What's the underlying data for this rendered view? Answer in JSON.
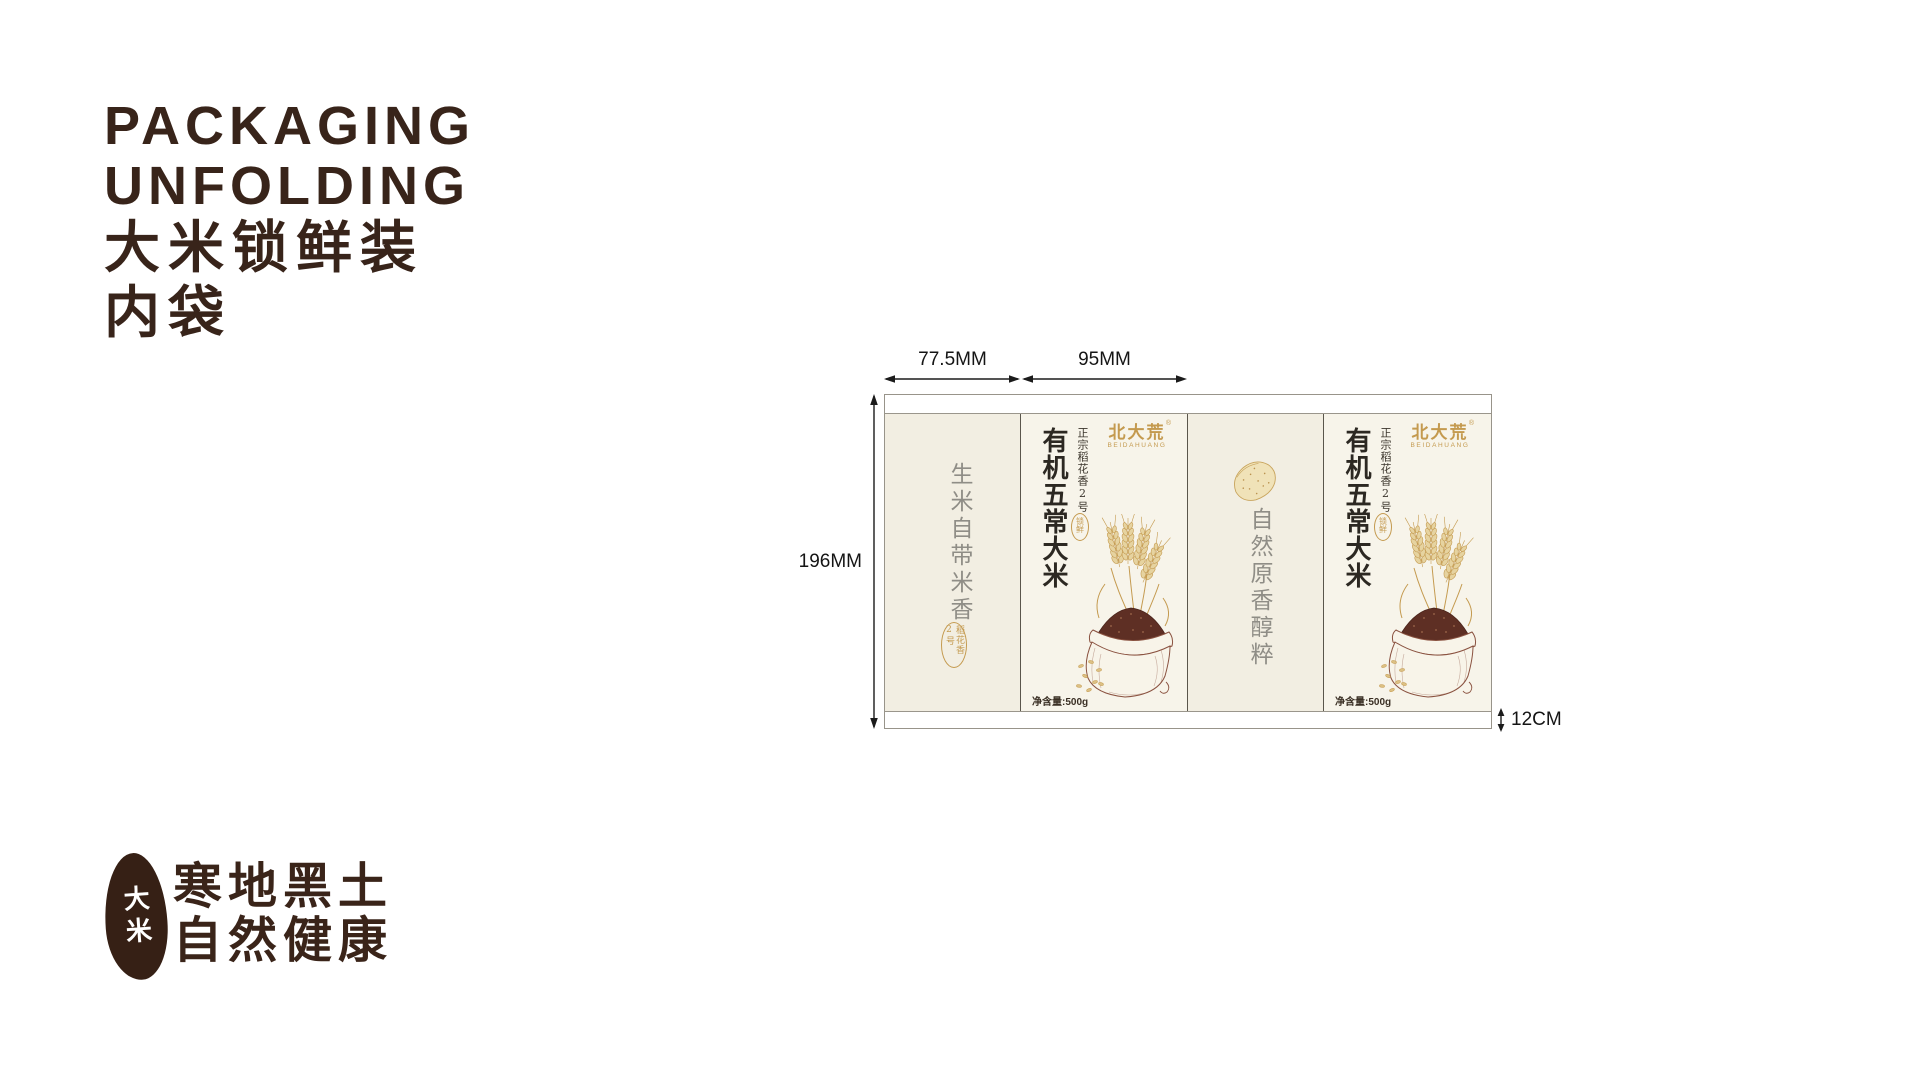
{
  "title": {
    "line1": "PACKAGING",
    "line2": "UNFOLDING",
    "line3": "大米锁鲜装",
    "line4": "内袋"
  },
  "dimensions": {
    "front_fold_width": "77.5MM",
    "main_panel_width": "95MM",
    "bag_height": "196MM",
    "side_depth": "12CM"
  },
  "package": {
    "left_fold_panel": {
      "slogan": "生米自带米香",
      "seal": "稻花香2号"
    },
    "main_panel": {
      "brand": "北大荒",
      "brand_en": "BEIDAHUANG",
      "trademark": "®",
      "origin": "正宗稻花香2号",
      "product": "有机五常大米",
      "seal": "锁鲜",
      "net_weight": "净含量:500g"
    },
    "right_fold_panel": {
      "slogan": "自然原香醇粹"
    }
  },
  "footer": {
    "badge": "大米",
    "slogan1": "寒地黑土",
    "slogan2": "自然健康"
  },
  "colors": {
    "ink_brown": "#38241a",
    "gold": "#c49a4f",
    "panel_cream": "#f2eee2",
    "panel_light": "#f7f4ea",
    "bag_brown": "#8a5240",
    "rice_dark": "#5e2f24",
    "text_gray": "#8f8d86"
  }
}
